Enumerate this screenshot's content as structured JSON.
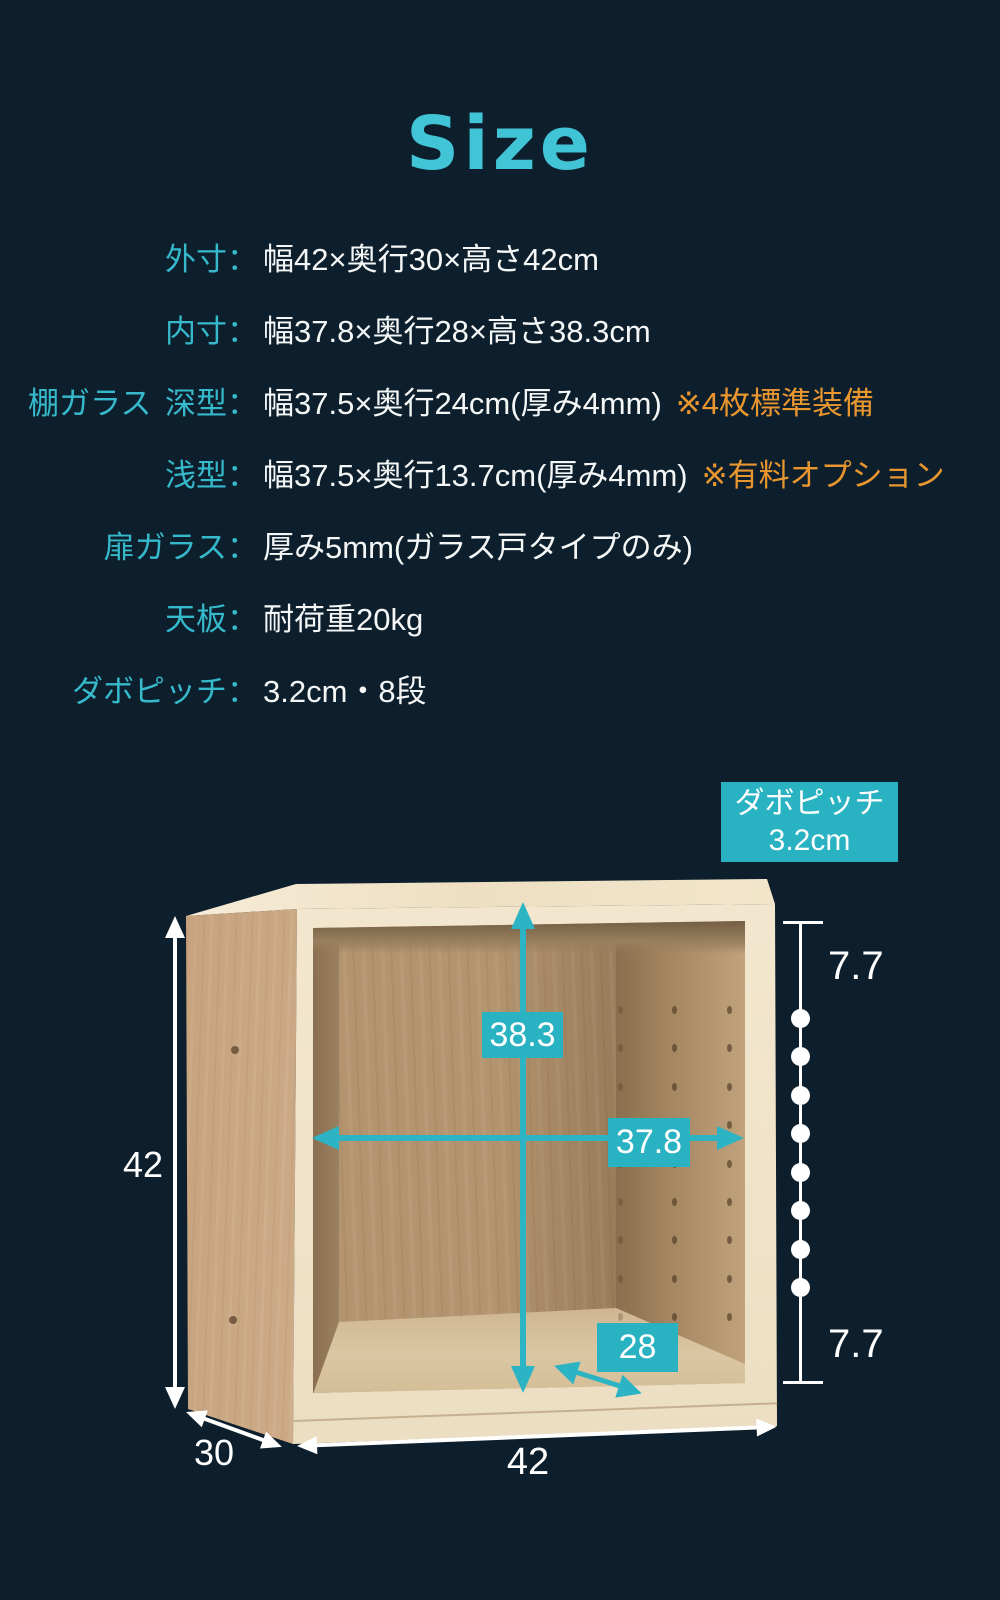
{
  "colors": {
    "teal": "#2cb4c4",
    "teal_text": "#35b9cb",
    "orange": "#e9962f",
    "background": "#0d1f2c",
    "callout_bg": "#29b2c2",
    "title_color": "#40c4d6"
  },
  "title": {
    "text": "Size"
  },
  "specs": {
    "rows": [
      {
        "prefix": "",
        "label": "外寸：",
        "value": "幅42×奥行30×高さ42cm",
        "note": ""
      },
      {
        "prefix": "",
        "label": "内寸：",
        "value": "幅37.8×奥行28×高さ38.3cm",
        "note": ""
      },
      {
        "prefix": "棚ガラス",
        "label": "深型：",
        "value": "幅37.5×奥行24cm(厚み4mm)",
        "note": "※4枚標準装備"
      },
      {
        "prefix": "",
        "label": "浅型：",
        "value": "幅37.5×奥行13.7cm(厚み4mm)",
        "note": "※有料オプション"
      },
      {
        "prefix": "",
        "label": "扉ガラス：",
        "value": "厚み5mm(ガラス戸タイプのみ)",
        "note": ""
      },
      {
        "prefix": "",
        "label": "天板：",
        "value": "耐荷重20kg",
        "note": ""
      },
      {
        "prefix": "",
        "label": "ダボピッチ：",
        "value": "3.2cm・8段",
        "note": ""
      }
    ]
  },
  "callout": {
    "line1": "ダボピッチ",
    "line2": "3.2cm"
  },
  "diagram": {
    "inner_height": "38.3",
    "inner_width": "37.8",
    "inner_depth": "28",
    "outer_height": "42",
    "outer_width": "42",
    "outer_depth": "30",
    "pitch_top": "7.7",
    "pitch_bottom": "7.7",
    "shelf_hole_count": 8,
    "shelf_hole_spacing": 38.43,
    "pin_hole_columns": [
      305,
      359,
      414
    ],
    "pin_hole_count": 9,
    "pin_hole_spacing": 38.4
  }
}
